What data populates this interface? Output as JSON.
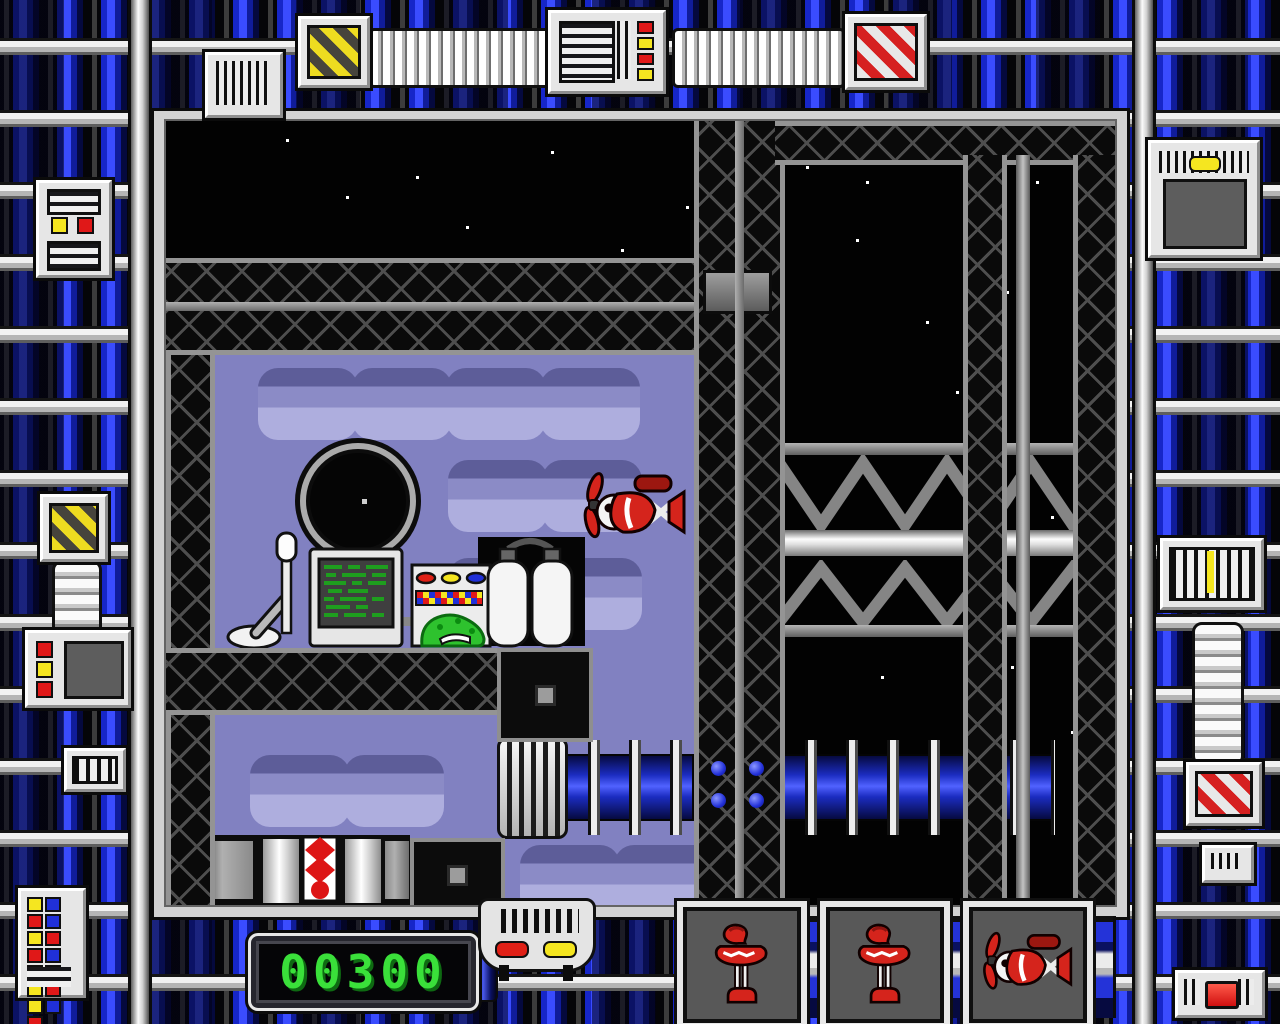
{
  "hud": {
    "score": {
      "label": "score",
      "value": "00300"
    },
    "lives": {
      "count": 3,
      "slots": [
        {
          "icon": "heli-lamp"
        },
        {
          "icon": "heli-lamp"
        },
        {
          "icon": "red-plane"
        }
      ]
    }
  },
  "game": {
    "player": {
      "icon": "red-plane-character",
      "facing": "left"
    },
    "objects": [
      "porthole",
      "computer-terminal",
      "control-panel",
      "green-slime",
      "gas-tanks",
      "desk-lamp",
      "vent-grate",
      "coil-pipe",
      "striped-roller",
      "truss-bridge",
      "girder-beam",
      "chain-wall-tiles",
      "star-field"
    ]
  },
  "frame": {
    "style": "blue-pipe-machinery-border",
    "panels": [
      "hazard-stripes-panel",
      "led-display-panel",
      "corrugated-tube",
      "candy-stripes-panel",
      "indicator-console",
      "insulator-stack",
      "barcode-grille",
      "button-grid-panel",
      "crt-monitor-panel",
      "vent-panel",
      "red-button-panel"
    ]
  },
  "colors": {
    "frame_blue": "#2a3ae0",
    "frame_metal": "#e8e8e8",
    "space_black": "#020202",
    "wall_purple": "#8181c1",
    "girder_gray": "#949494",
    "score_green": "#3ae03a",
    "char_red": "#d5241c",
    "accent_yellow": "#f5e620",
    "accent_blue": "#2030d8",
    "accent_red": "#e01818"
  }
}
